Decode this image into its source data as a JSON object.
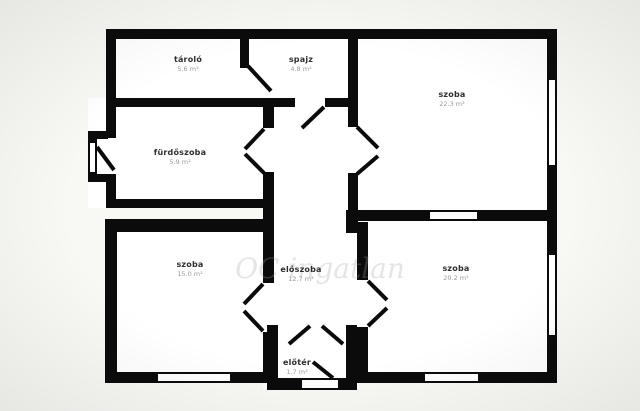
{
  "colors": {
    "background": "#f8f8f5",
    "plan_interior": "#ffffff",
    "wall": "#0b0b0b",
    "room_name_text": "#2e2e2e",
    "room_area_text": "#9b9b9b"
  },
  "watermark": {
    "text": "OC ingatlan"
  },
  "rooms": [
    {
      "id": "tarolo",
      "name": "tároló",
      "area": "5.6 m²"
    },
    {
      "id": "spajz",
      "name": "spajz",
      "area": "4.8 m²"
    },
    {
      "id": "szoba-top-right",
      "name": "szoba",
      "area": "22.3 m²"
    },
    {
      "id": "furdoszoba",
      "name": "fürdőszoba",
      "area": "5.9 m²"
    },
    {
      "id": "szoba-bottom-left",
      "name": "szoba",
      "area": "15.0 m²"
    },
    {
      "id": "eloszoba",
      "name": "előszoba",
      "area": "12.7 m²"
    },
    {
      "id": "szoba-bottom-right",
      "name": "szoba",
      "area": "20.2 m²"
    },
    {
      "id": "eloter",
      "name": "előtér",
      "area": "1.7 m²"
    }
  ]
}
